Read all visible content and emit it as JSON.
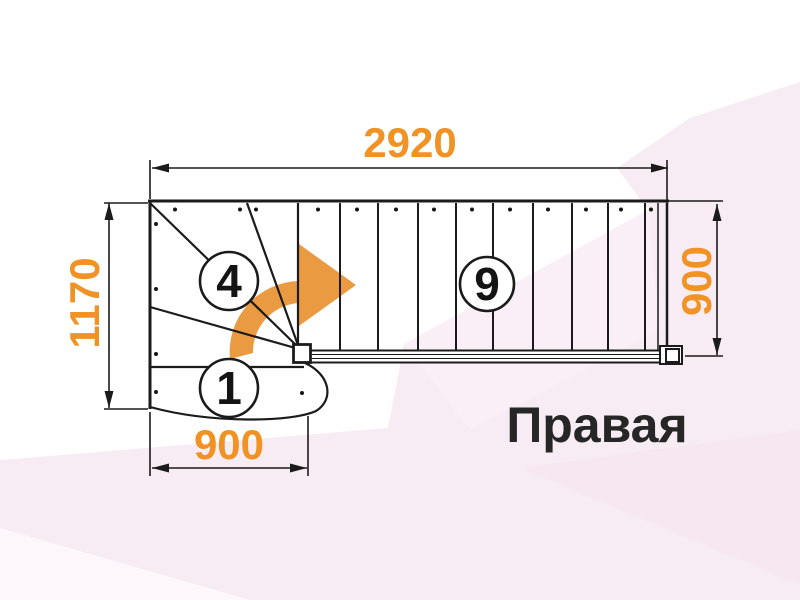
{
  "drawing": {
    "type_label": "staircase-floor-plan",
    "orientation_label": "Правая",
    "dimensions": {
      "total_length_top": "2920",
      "total_depth_left": "1170",
      "flight_width_right": "900",
      "entry_width_bottom": "900"
    },
    "step_numbers": {
      "winder_step": "4",
      "first_step": "1",
      "straight_flight_step": "9"
    },
    "icons": {
      "direction_arrow": "curved-right-arrow"
    },
    "colors": {
      "dimension_text": "#f09224",
      "direction_arrow": "#ea9b42",
      "outline": "#1b1b1b",
      "label_text": "#262626",
      "background_tint": "#f8ecf4"
    }
  }
}
